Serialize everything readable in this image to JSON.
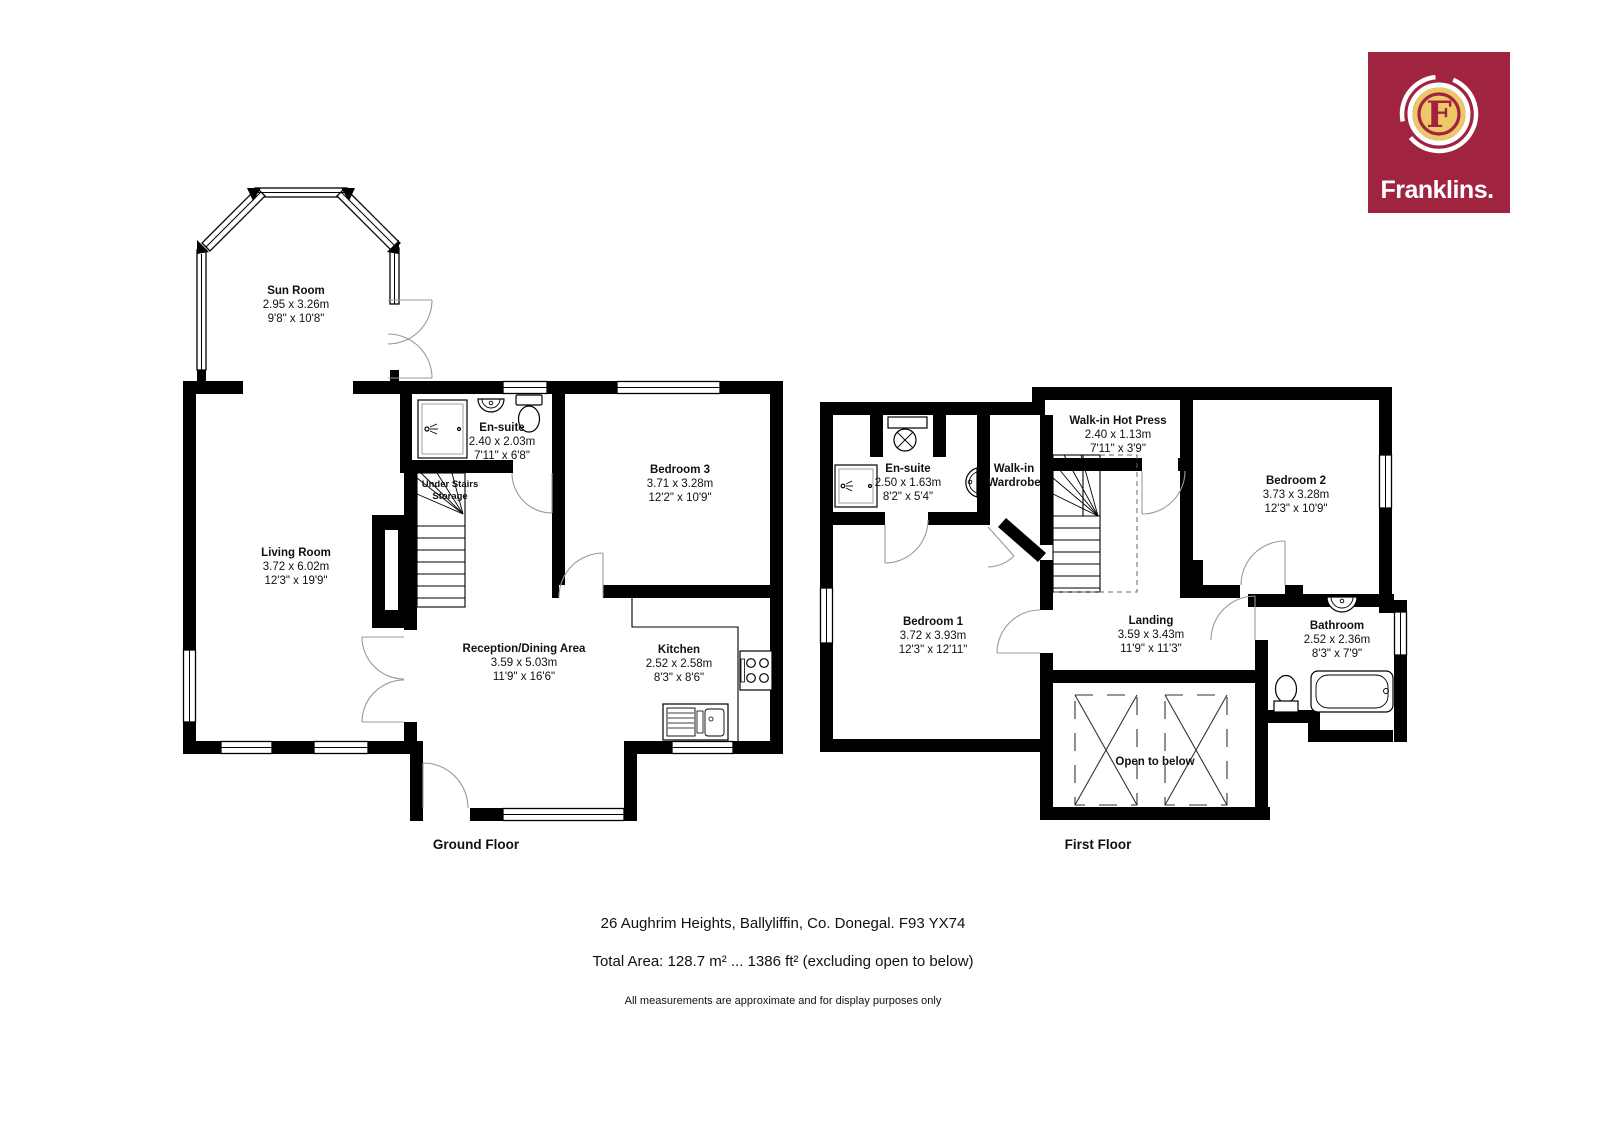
{
  "logo": {
    "brand": "Franklins.",
    "monogram": "F",
    "bg_color": "#A02340",
    "gold_color": "#EDC868"
  },
  "floors": {
    "ground": {
      "title": "Ground Floor",
      "rooms": {
        "sun_room": {
          "name": "Sun Room",
          "metric": "2.95 x 3.26m",
          "imperial": "9'8\" x 10'8\""
        },
        "ensuite": {
          "name": "En-suite",
          "metric": "2.40 x 2.03m",
          "imperial": "7'11\" x 6'8\""
        },
        "bedroom3": {
          "name": "Bedroom 3",
          "metric": "3.71 x 3.28m",
          "imperial": "12'2\" x 10'9\""
        },
        "understairs": {
          "line1": "Under Stairs",
          "line2": "Storage"
        },
        "living": {
          "name": "Living Room",
          "metric": "3.72 x 6.02m",
          "imperial": "12'3\" x 19'9\""
        },
        "reception": {
          "name": "Reception/Dining Area",
          "metric": "3.59 x 5.03m",
          "imperial": "11'9\" x 16'6\""
        },
        "kitchen": {
          "name": "Kitchen",
          "metric": "2.52 x 2.58m",
          "imperial": "8'3\" x 8'6\""
        }
      }
    },
    "first": {
      "title": "First Floor",
      "rooms": {
        "ensuite": {
          "name": "En-suite",
          "metric": "2.50 x 1.63m",
          "imperial": "8'2\" x 5'4\""
        },
        "wardrobe": {
          "line1": "Walk-in",
          "line2": "Wardrobe"
        },
        "hot_press": {
          "name": "Walk-in Hot Press",
          "metric": "2.40 x 1.13m",
          "imperial": "7'11\" x 3'9\""
        },
        "bedroom2": {
          "name": "Bedroom 2",
          "metric": "3.73 x 3.28m",
          "imperial": "12'3\" x 10'9\""
        },
        "bedroom1": {
          "name": "Bedroom 1",
          "metric": "3.72 x 3.93m",
          "imperial": "12'3\" x 12'11\""
        },
        "landing": {
          "name": "Landing",
          "metric": "3.59 x 3.43m",
          "imperial": "11'9\" x 11'3\""
        },
        "bathroom": {
          "name": "Bathroom",
          "metric": "2.52 x 2.36m",
          "imperial": "8'3\" x 7'9\""
        },
        "open_below": {
          "name": "Open to below"
        }
      }
    }
  },
  "footer": {
    "address": "26 Aughrim Heights, Ballyliffin, Co. Donegal. F93 YX74",
    "total_area": "Total Area: 128.7 m² ... 1386 ft² (excluding open to below)",
    "disclaimer": "All measurements are approximate and for display purposes only"
  }
}
